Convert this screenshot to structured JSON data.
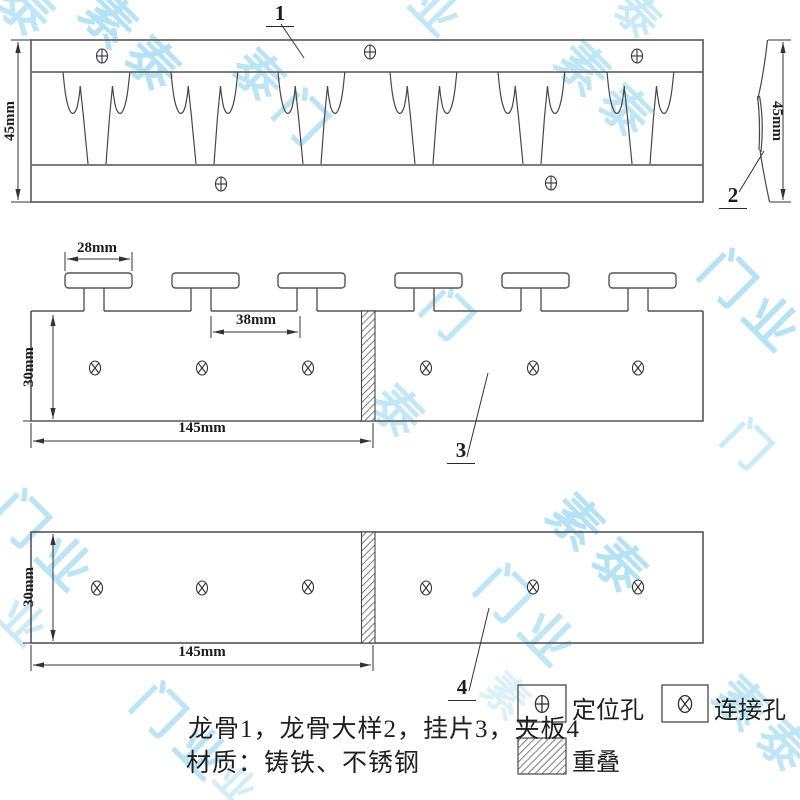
{
  "drawing": {
    "caption_line1": "龙骨1，龙骨大样2，挂片3，夹板4",
    "caption_line2": "材质：铸铁、不锈钢",
    "part_labels": {
      "keel": "1",
      "keel_side_detail": "2",
      "hanger": "3",
      "clamp_plate": "4"
    },
    "dimensions": {
      "keel_height": "45mm",
      "keel_side_height": "45mm",
      "t_top_width": "28mm",
      "t_spacing": "38mm",
      "hanger_length": "145mm",
      "hanger_height": "30mm",
      "plate_length": "145mm",
      "plate_height": "30mm"
    },
    "legend": {
      "positioning_hole": "定位孔",
      "connection_hole": "连接孔",
      "overlap": "重叠"
    }
  },
  "watermark": {
    "text": "素泰门业",
    "color": "#a6dbf2",
    "instances": [
      {
        "x": 28,
        "y": 12,
        "t": "泰",
        "s": 54,
        "o": 0.7
      },
      {
        "x": 133,
        "y": 46,
        "t": "素泰",
        "s": 52,
        "o": 0.8
      },
      {
        "x": 283,
        "y": 100,
        "t": "泰门",
        "s": 50,
        "o": 0.75
      },
      {
        "x": 438,
        "y": 14,
        "t": "业",
        "s": 48,
        "o": 0.65
      },
      {
        "x": 640,
        "y": 20,
        "t": "泰",
        "s": 44,
        "o": 0.6
      },
      {
        "x": 607,
        "y": 93,
        "t": "素泰",
        "s": 50,
        "o": 0.7
      },
      {
        "x": 752,
        "y": 305,
        "t": "门业",
        "s": 52,
        "o": 0.8
      },
      {
        "x": 450,
        "y": 318,
        "t": "门",
        "s": 48,
        "o": 0.7
      },
      {
        "x": 400,
        "y": 415,
        "t": "泰",
        "s": 50,
        "o": 0.65
      },
      {
        "x": 750,
        "y": 448,
        "t": "门",
        "s": 46,
        "o": 0.55
      },
      {
        "x": 45,
        "y": 545,
        "t": "门业",
        "s": 52,
        "o": 0.75
      },
      {
        "x": 25,
        "y": 625,
        "t": "业",
        "s": 46,
        "o": 0.55
      },
      {
        "x": 600,
        "y": 548,
        "t": "素泰",
        "s": 52,
        "o": 0.8
      },
      {
        "x": 528,
        "y": 620,
        "t": "门业",
        "s": 52,
        "o": 0.7
      },
      {
        "x": 183,
        "y": 735,
        "t": "门业",
        "s": 50,
        "o": 0.75
      },
      {
        "x": 765,
        "y": 728,
        "t": "素泰",
        "s": 50,
        "o": 0.7
      },
      {
        "x": 508,
        "y": 700,
        "t": "素",
        "s": 44,
        "o": 0.4
      },
      {
        "x": 238,
        "y": 788,
        "t": "业",
        "s": 40,
        "o": 0.5
      }
    ]
  },
  "colors": {
    "outline": "#6a6a6a",
    "line": "#4a4a4a",
    "dim": "#333333",
    "watermark": "#a6dbf2"
  }
}
